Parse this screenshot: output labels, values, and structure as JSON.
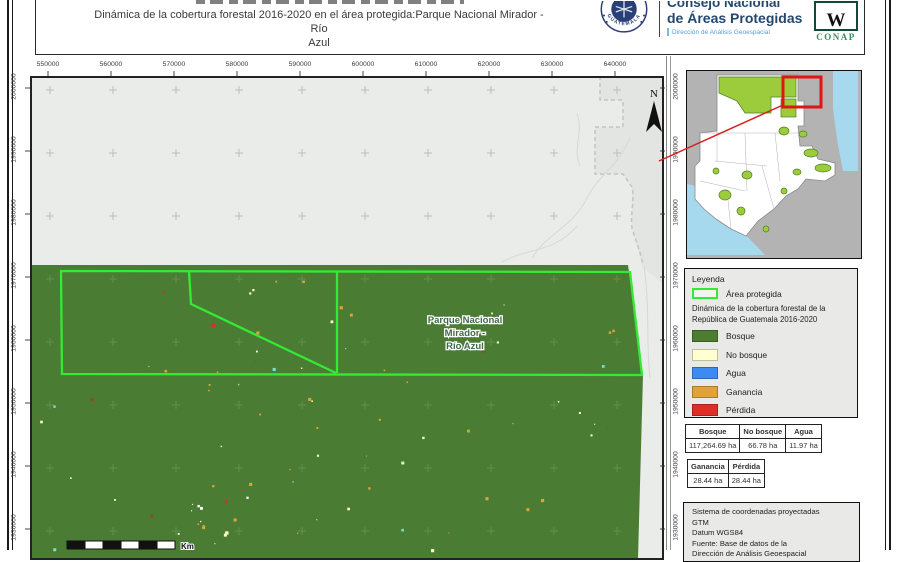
{
  "header": {
    "title_lines": [
      "Dinámica de la cobertura forestal 2016-2020 en el área protegida:Parque Nacional Mirador - Río",
      "Azul"
    ],
    "org": {
      "name_line1": "Consejo Nacional",
      "name_line2": "de Áreas Protegidas",
      "department": "Dirección de Análisis Geoespacial",
      "seal_text": "GUATEMALA",
      "conap_text": "CONAP"
    }
  },
  "map": {
    "north_label": "N",
    "area_label_lines": [
      "Parque Nacional",
      "Mirador -",
      "Río Azul"
    ],
    "scalebar_unit": "Km",
    "x_tick_labels": [
      "550000",
      "560000",
      "570000",
      "580000",
      "590000",
      "600000",
      "610000",
      "620000",
      "630000",
      "640000"
    ],
    "y_tick_labels": [
      "2000000",
      "1990000",
      "1980000",
      "1970000",
      "1960000",
      "1950000",
      "1940000",
      "1930000"
    ],
    "colors": {
      "forest": "#4a7c34",
      "background": "#e9ece8",
      "protected_outline": "#35ea35",
      "inset_highlight": "#e01616"
    }
  },
  "legend": {
    "title": "Leyenda",
    "protected_area_label": "Área protegida",
    "subtitle": "Dinámica de la cobertura forestal de la República de Guatemala 2016-2020",
    "classes": [
      {
        "label": "Bosque",
        "color": "#4c7d31"
      },
      {
        "label": "No bosque",
        "color": "#ffffd2"
      },
      {
        "label": "Agua",
        "color": "#3d8bf2"
      },
      {
        "label": "Ganancia",
        "color": "#e2a23a"
      },
      {
        "label": "Pérdida",
        "color": "#dd2f26"
      }
    ]
  },
  "tables": [
    {
      "headers": [
        "Bosque",
        "No bosque",
        "Agua"
      ],
      "values": [
        "117,264.69 ha",
        "66.78 ha",
        "11.97 ha"
      ]
    },
    {
      "headers": [
        "Ganancia",
        "Pérdida"
      ],
      "values": [
        "28.44 ha",
        "28.44 ha"
      ]
    }
  ],
  "source_box": {
    "lines": [
      "Sistema de coordenadas proyectadas",
      "GTM",
      "Datum WGS84",
      "Fuente: Base de datos de la",
      "Dirección de Análisis Geoespacial"
    ]
  }
}
